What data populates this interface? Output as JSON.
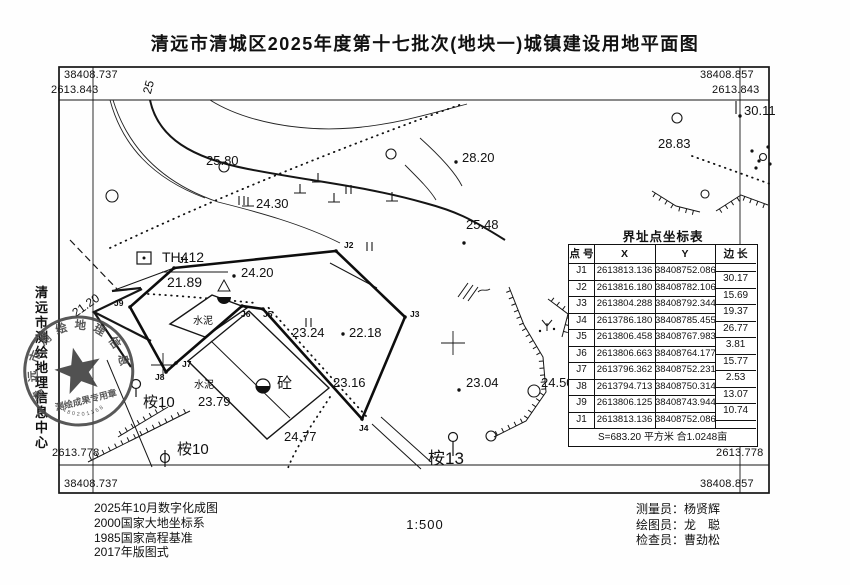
{
  "title": "清远市清城区2025年度第十七批次(地块一)城镇建设用地平面图",
  "scale_label": "1:500",
  "corner_coords": {
    "top_left_e": "38408.737",
    "top_left_n": "2613.843",
    "top_right_e": "38408.857",
    "top_right_n": "2613.843",
    "bottom_left_n": "2613.778",
    "bottom_left_e": "38408.737",
    "bottom_right_n": "2613.778",
    "bottom_right_e": "38408.857"
  },
  "margin_text": "清远市测绘地理信息中心",
  "stamp": {
    "ring_text": "清远市测绘地理信息中心",
    "banner": "测绘成果专用章",
    "serial": "4480201368"
  },
  "coord_table": {
    "title": "界址点坐标表",
    "headers": [
      "点 号",
      "X",
      "Y",
      "边 长"
    ],
    "rows": [
      [
        "J1",
        "2613813.136",
        "38408752.086"
      ],
      [
        "J2",
        "2613816.180",
        "38408782.106"
      ],
      [
        "J3",
        "2613804.288",
        "38408792.344"
      ],
      [
        "J4",
        "2613786.180",
        "38408785.455"
      ],
      [
        "J5",
        "2613806.458",
        "38408767.983"
      ],
      [
        "J6",
        "2613806.663",
        "38408764.177"
      ],
      [
        "J7",
        "2613796.362",
        "38408752.231"
      ],
      [
        "J8",
        "2613794.713",
        "38408750.314"
      ],
      [
        "J9",
        "2613806.125",
        "38408743.944"
      ],
      [
        "J1",
        "2613813.136",
        "38408752.086"
      ]
    ],
    "edge_lengths": [
      "30.17",
      "15.69",
      "19.37",
      "26.77",
      "3.81",
      "15.77",
      "2.53",
      "13.07",
      "10.74"
    ],
    "footer": "S=683.20 平方米 合1.0248亩"
  },
  "map_labels": [
    {
      "t": "25",
      "x": 141,
      "y": 92,
      "s": 12,
      "r": -75
    },
    {
      "t": "25.80",
      "x": 206,
      "y": 154,
      "s": 13
    },
    {
      "t": "24.30",
      "x": 256,
      "y": 197,
      "s": 13
    },
    {
      "t": "28.20",
      "x": 462,
      "y": 151,
      "s": 13
    },
    {
      "t": "25.48",
      "x": 466,
      "y": 218,
      "s": 13
    },
    {
      "t": "28.83",
      "x": 658,
      "y": 137,
      "s": 13
    },
    {
      "t": "30.11",
      "x": 744,
      "y": 104,
      "s": 13
    },
    {
      "t": "21.20",
      "x": 70,
      "y": 309,
      "s": 12,
      "r": -35
    },
    {
      "t": "TH412",
      "x": 162,
      "y": 250,
      "s": 14
    },
    {
      "t": "21.89",
      "x": 167,
      "y": 275,
      "s": 14
    },
    {
      "t": "24.20",
      "x": 241,
      "y": 266,
      "s": 13
    },
    {
      "t": "23.24",
      "x": 292,
      "y": 326,
      "s": 13
    },
    {
      "t": "22.18",
      "x": 349,
      "y": 326,
      "s": 13
    },
    {
      "t": "23.16",
      "x": 333,
      "y": 376,
      "s": 13
    },
    {
      "t": "23.79",
      "x": 198,
      "y": 395,
      "s": 13
    },
    {
      "t": "24.77",
      "x": 284,
      "y": 430,
      "s": 13
    },
    {
      "t": "23.04",
      "x": 466,
      "y": 376,
      "s": 13
    },
    {
      "t": "24.50",
      "x": 541,
      "y": 376,
      "s": 13
    },
    {
      "t": "水泥",
      "x": 193,
      "y": 317,
      "s": 10
    },
    {
      "t": "水泥",
      "x": 194,
      "y": 381,
      "s": 10
    },
    {
      "t": "砼",
      "x": 277,
      "y": 376,
      "s": 15
    },
    {
      "t": "桉10",
      "x": 143,
      "y": 395,
      "s": 15
    },
    {
      "t": "桉10",
      "x": 177,
      "y": 442,
      "s": 15
    },
    {
      "t": "桉13",
      "x": 428,
      "y": 450,
      "s": 17
    },
    {
      "t": "J1",
      "x": 179,
      "y": 256,
      "s": 8.5,
      "b": 1
    },
    {
      "t": "J2",
      "x": 344,
      "y": 241,
      "s": 8.5,
      "b": 1
    },
    {
      "t": "J3",
      "x": 410,
      "y": 310,
      "s": 8.5,
      "b": 1
    },
    {
      "t": "J4",
      "x": 359,
      "y": 424,
      "s": 8.5,
      "b": 1
    },
    {
      "t": "J5",
      "x": 263,
      "y": 310,
      "s": 8.5,
      "b": 1
    },
    {
      "t": "J6",
      "x": 241,
      "y": 310,
      "s": 8.5,
      "b": 1
    },
    {
      "t": "J7",
      "x": 182,
      "y": 360,
      "s": 8.5,
      "b": 1
    },
    {
      "t": "J8",
      "x": 155,
      "y": 373,
      "s": 8.5,
      "b": 1
    },
    {
      "t": "J9",
      "x": 114,
      "y": 299,
      "s": 8.5,
      "b": 1
    }
  ],
  "notes": [
    "2025年10月数字化成图",
    "2000国家大地坐标系",
    "1985国家高程基准",
    "2017年版图式"
  ],
  "credits": [
    "测量员：杨贤辉",
    "绘图员：龙　聪",
    "检查员：曹劲松"
  ]
}
